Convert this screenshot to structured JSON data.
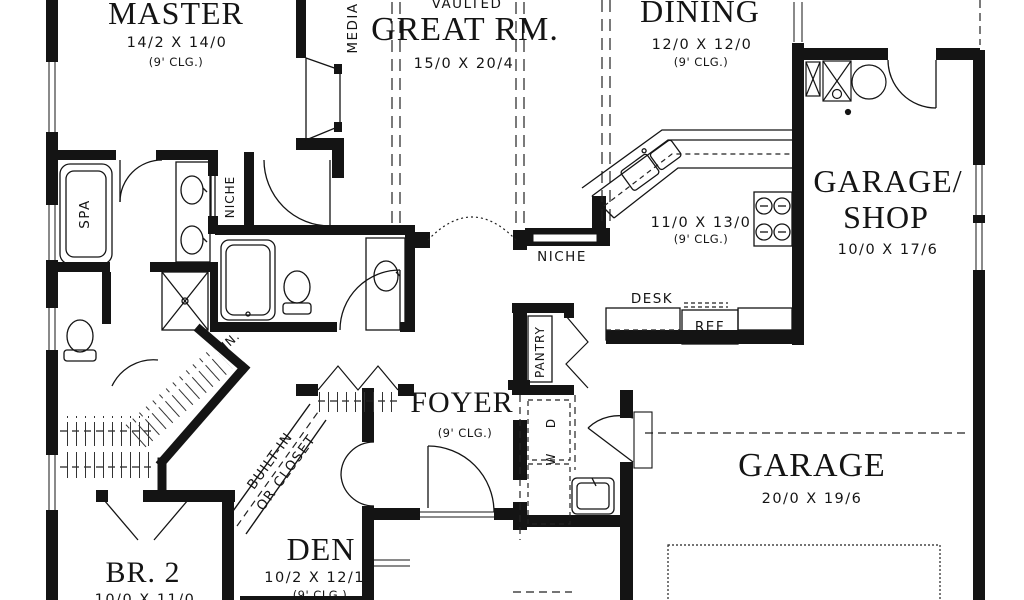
{
  "canvas": {
    "width": 1024,
    "height": 600,
    "background": "#ffffff",
    "ink": "#141414"
  },
  "rooms": {
    "master": {
      "name": "MASTER",
      "dims": "14/2 X 14/0",
      "clg": "(9' CLG.)"
    },
    "great_room": {
      "vaulted": "VAULTED",
      "name": "GREAT RM.",
      "dims": "15/0 X 20/4"
    },
    "dining": {
      "name": "DINING",
      "dims": "12/0 X 12/0",
      "clg": "(9' CLG.)"
    },
    "garage_shop": {
      "name_line1": "GARAGE/",
      "name_line2": "SHOP",
      "dims": "10/0 X 17/6"
    },
    "kitchen": {
      "dims": "11/0 X 13/0",
      "clg": "(9' CLG.)"
    },
    "foyer": {
      "name": "FOYER",
      "clg": "(9' CLG.)"
    },
    "den": {
      "name": "DEN",
      "dims": "10/2 X 12/10",
      "clg": "(9' CLG.)"
    },
    "bedroom2": {
      "name": "BR. 2",
      "dims": "10/0 X 11/0"
    },
    "garage": {
      "name": "GARAGE",
      "dims": "20/0 X 19/6"
    }
  },
  "labels": {
    "niche_hall": "NICHE",
    "niche_master": "NICHE",
    "desk": "DESK",
    "ref": "REF",
    "pantry": "PANTRY",
    "washer": "W",
    "dryer": "D",
    "spa": "SPA",
    "media": "MEDIA",
    "linen": "LIN.",
    "builtin_line1": "BUILT-IN",
    "builtin_line2": "OR CLOSET"
  }
}
